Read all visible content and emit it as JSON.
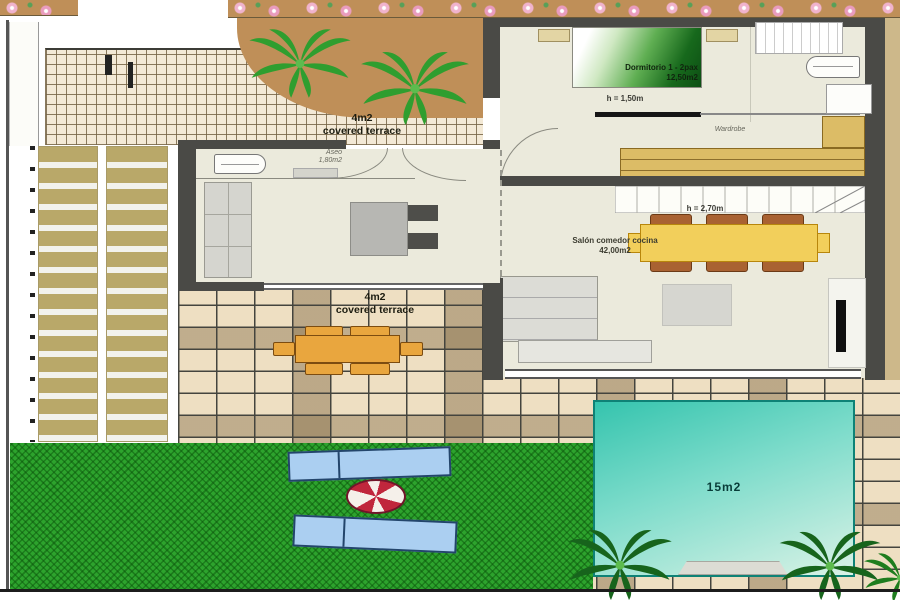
{
  "plan": {
    "bedroom": {
      "name_line": "Dormitorio 1 - 2pax",
      "area_line": "12,50m2",
      "height_note": "h = 1,50m",
      "wardrobe_label": "Wardrobe"
    },
    "aseo": {
      "name_line": "Aseo",
      "area_line": "1,80m2"
    },
    "living": {
      "name_line": "Salón comedor cocina",
      "area_line": "42,00m2",
      "height_note": "h = 2,70m"
    },
    "terrace_upper": {
      "area_line": "4m2",
      "name_line": "covered terrace"
    },
    "terrace_lower": {
      "area_line": "4m2",
      "name_line": "covered terrace"
    },
    "pool": {
      "area_line": "15m2"
    }
  },
  "colors": {
    "pool_water": "#35c4ae",
    "grass": "#2da32d",
    "walls": "#4a4a46",
    "wardrobe_tan": "#dcbc66",
    "dining_table_yellow": "#f2cf5b",
    "outdoor_table_orange": "#e9a63e",
    "lounger_blue": "#abcff1",
    "ball_red": "#c0263c",
    "bed_green": "#17691c",
    "soil_brown": "#bf8f58"
  }
}
